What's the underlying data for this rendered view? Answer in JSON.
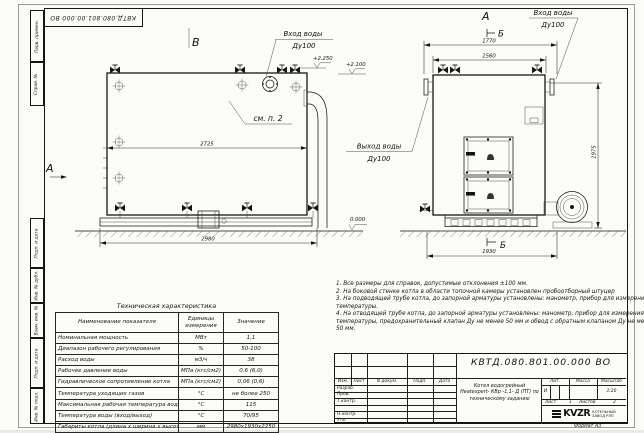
{
  "sheet": {
    "doc_number": "КВТД.080.801.00.000 ВО",
    "format_label": "Формат А3",
    "margin_labels": [
      "Перв. примен.",
      "Справ. №",
      "Подп. и дата",
      "Инв. № дубл.",
      "Взам. инв. №",
      "Подп. и дата",
      "Инв. № подл."
    ]
  },
  "drawing": {
    "markers": {
      "top_left": "В",
      "front_top": "А",
      "section_top": "Б",
      "section_bottom": "Б",
      "side_arrow": "А"
    },
    "labels": {
      "inlet_water": "Вход воды",
      "outlet_water": "Выход воды",
      "dn": "Ду100",
      "see_item": "см. п. 2",
      "elev_2250": "+2.250",
      "elev_2100": "+2.100",
      "elev_zero": "0.000"
    },
    "dims": {
      "side_overall": "2980",
      "side_inner": "2725",
      "front_top": "1770",
      "front_inner": "1560",
      "height": "1975",
      "front_bottom": "1930"
    }
  },
  "notes": {
    "lines": [
      "1. Все размеры для справок, допустимые отклонения ±100 мм.",
      "2. На боковой стенке котла в области топочной камеры установлен пробоотборный штуцер",
      "3. На подводящей трубе котла, до запорной арматуры установлены: манометр, прибор для измерения",
      "температуры.",
      "4. На отводящей трубе котла, до запорной арматуры установлены: манометр, прибор для измерения",
      "температуры, предохранительный клапан Ду не менее 50 мм и обвод с обратным клапаном Ду не менее",
      "50 мм."
    ]
  },
  "tech_table": {
    "title": "Техническая характеристика",
    "headers": [
      "Наименование показателя",
      "Единицы измерения",
      "Значение"
    ],
    "rows": [
      [
        "Номинальная мощность",
        "МВт",
        "1,1"
      ],
      [
        "Диапазон рабочего регулирования",
        "%",
        "50-100"
      ],
      [
        "Расход воды",
        "м3/ч",
        "38"
      ],
      [
        "Рабочее давление воды",
        "МПа (кгс/см2)",
        "0,6 (6,0)"
      ],
      [
        "Гидравлическое сопротивление котла",
        "МПа (кгс/см2)",
        "0,06 (0,6)"
      ],
      [
        "Температура уходящих газов",
        "°С",
        "не более 250"
      ],
      [
        "Максимальная рабочая температура воды",
        "°С",
        "115"
      ],
      [
        "Температура воды (вход/выход)",
        "°С",
        "70/95"
      ],
      [
        "Габариты котла (длина х ширина х высота)",
        "мм",
        "2980х1930х2250"
      ]
    ]
  },
  "title_block": {
    "doc_number": "КВТД.080.801.00.000  ВО",
    "columns": [
      "Изм.",
      "Лист",
      "N докум.",
      "Подп.",
      "Дата"
    ],
    "signature_rows": [
      "Разраб.",
      "Пров.",
      "Т.контр.",
      "",
      "Н.контр.",
      "Утв."
    ],
    "name_lines": [
      "Котел водогрейный",
      "Heatexpert- КВр -1,1- Д (ПТ) по",
      "техническому заданию"
    ],
    "lit_header": "Лит.",
    "mass_header": "Масса",
    "scale_header": "Масштаб",
    "lit_value": "И",
    "scale_value": "1:20",
    "sheet_label": "Лист",
    "sheet_number": "1",
    "sheets_label": "Листов",
    "sheets_total": "2",
    "company_logo": "KVZR",
    "company_line1": "КОТЕЛЬНЫЙ",
    "company_line2": "ЗАВОД РЭП"
  }
}
